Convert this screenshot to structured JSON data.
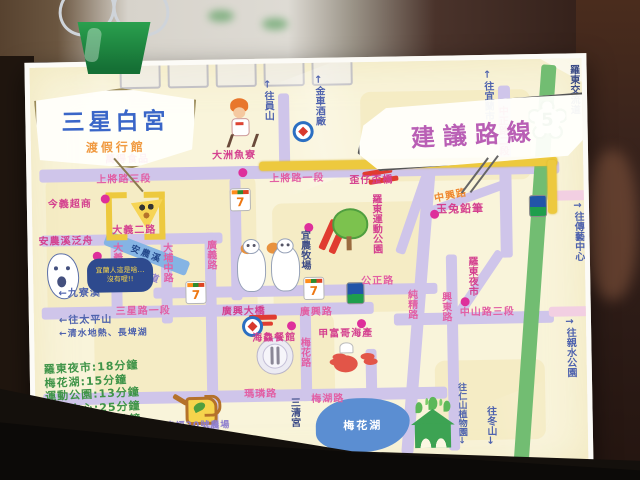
{
  "map": {
    "title_bubble": {
      "name": "三星白宮",
      "subtitle": "渡假行館"
    },
    "route_bubble": {
      "label": "建議路線"
    },
    "highway": {
      "number": "5",
      "interchange_label": "羅東交流道"
    },
    "river": {
      "name": "安農溪"
    },
    "lake": {
      "label": "梅花湖"
    },
    "speech": {
      "lines": [
        "宜蘭人這是啥…",
        "沒有喔!!"
      ]
    },
    "legend": [
      {
        "dest": "羅東夜市",
        "time": "18分鐘"
      },
      {
        "dest": "梅花湖",
        "time": "15分鐘"
      },
      {
        "dest": "運動公園",
        "time": "13分鐘"
      },
      {
        "dest": "傳藝中心",
        "time": "25分鐘"
      },
      {
        "dest": "親水公園",
        "time": "25分鐘"
      }
    ],
    "road_labels": [
      {
        "t": "上將路三段",
        "x": 65,
        "y": 104
      },
      {
        "t": "上將路一段",
        "x": 238,
        "y": 106
      },
      {
        "t": "歪仔歪橋",
        "x": 318,
        "y": 109,
        "c": "pk2"
      },
      {
        "t": "大義二路",
        "x": 80,
        "y": 155,
        "c": "pk2"
      },
      {
        "t": "大義路",
        "x": 76,
        "y": 176,
        "v": 1
      },
      {
        "t": "大埔中路",
        "x": 126,
        "y": 177,
        "v": 1
      },
      {
        "t": "廣義路",
        "x": 170,
        "y": 175,
        "v": 1
      },
      {
        "t": "自行車道",
        "x": 88,
        "y": 200,
        "c": "pur",
        "r": 22,
        "s": 9
      },
      {
        "t": "三星路一段",
        "x": 82,
        "y": 236
      },
      {
        "t": "廣興大橋",
        "x": 188,
        "y": 238,
        "c": "pk2"
      },
      {
        "t": "廣興路",
        "x": 266,
        "y": 240
      },
      {
        "t": "公正路",
        "x": 328,
        "y": 210
      },
      {
        "t": "中興路",
        "x": 402,
        "y": 126,
        "c": "org",
        "r": -10
      },
      {
        "t": "中正路二段",
        "x": 464,
        "y": 46,
        "v": 1,
        "c": "pk2"
      },
      {
        "t": "純精路",
        "x": 370,
        "y": 228,
        "v": 1
      },
      {
        "t": "興東路",
        "x": 404,
        "y": 231,
        "v": 1
      },
      {
        "t": "中山路三段",
        "x": 426,
        "y": 243
      },
      {
        "t": "梅花路",
        "x": 262,
        "y": 274,
        "v": 1
      },
      {
        "t": "瑪璘路",
        "x": 209,
        "y": 321
      },
      {
        "t": "梅湖路",
        "x": 276,
        "y": 327
      }
    ],
    "place_labels": [
      {
        "t": "今義超商",
        "x": 16,
        "y": 128
      },
      {
        "t": "萬得食品",
        "x": 74,
        "y": 84,
        "c": "pink"
      },
      {
        "t": "大洲魚寮",
        "x": 181,
        "y": 82
      },
      {
        "t": "安農溪泛舟",
        "x": 6,
        "y": 165
      },
      {
        "t": "玉兔鉛筆",
        "x": 404,
        "y": 140,
        "s": 11
      },
      {
        "t": "羅東運動公園",
        "x": 336,
        "y": 132,
        "v": 1
      },
      {
        "t": "羅東夜市",
        "x": 431,
        "y": 196,
        "v": 1
      },
      {
        "t": "海鱻餐館",
        "x": 218,
        "y": 265
      },
      {
        "t": "甲富哥海產",
        "x": 284,
        "y": 262
      },
      {
        "t": "宜農牧場",
        "x": 264,
        "y": 167,
        "v": 1,
        "c": "nav"
      },
      {
        "t": "三清宮",
        "x": 251,
        "y": 334,
        "v": 1,
        "c": "nav"
      },
      {
        "t": "幸福20號農場",
        "x": 130,
        "y": 353,
        "c": "pur",
        "s": 9
      }
    ],
    "direction_labels": [
      {
        "t": "↑往員山",
        "x": 230,
        "y": 16,
        "v": 1
      },
      {
        "t": "↑金車酒廠",
        "x": 281,
        "y": 12,
        "v": 1
      },
      {
        "t": "↑往宜蘭市",
        "x": 450,
        "y": 10,
        "v": 1
      },
      {
        "t": "羅東交流道",
        "x": 536,
        "y": 6,
        "v": 1,
        "c": "nav"
      },
      {
        "t": "→往傳藝中心",
        "x": 538,
        "y": 142,
        "v": 1
      },
      {
        "t": "→往親水公園",
        "x": 528,
        "y": 258,
        "v": 1
      },
      {
        "t": "往冬山↓",
        "x": 447,
        "y": 346,
        "v": 1
      },
      {
        "t": "往仁山植物園↓",
        "x": 420,
        "y": 322,
        "v": 1,
        "s": 9
      },
      {
        "t": "←九寮溪",
        "x": 25,
        "y": 217
      },
      {
        "t": "←往太平山",
        "x": 25,
        "y": 244
      },
      {
        "t": "←清水地熱、長埤湖",
        "x": 25,
        "y": 259,
        "s": 9
      }
    ],
    "roads": [
      {
        "x": 8,
        "y": 102,
        "w": 520,
        "h": 13
      },
      {
        "x": 8,
        "y": 168,
        "w": 182,
        "h": 11
      },
      {
        "x": 120,
        "y": 222,
        "w": 284,
        "h": 11
      },
      {
        "x": 8,
        "y": 240,
        "w": 332,
        "h": 12
      },
      {
        "x": 8,
        "y": 326,
        "w": 404,
        "h": 12
      },
      {
        "x": 360,
        "y": 252,
        "w": 160,
        "h": 12
      },
      {
        "x": 515,
        "y": 132,
        "w": 52,
        "h": 10,
        "c": "pinkr"
      },
      {
        "x": 515,
        "y": 248,
        "w": 52,
        "h": 10,
        "c": "pinkr"
      },
      {
        "x": 78,
        "y": 174,
        "w": 11,
        "h": 78
      },
      {
        "x": 128,
        "y": 174,
        "w": 11,
        "h": 84
      },
      {
        "x": 172,
        "y": 168,
        "w": 11,
        "h": 208
      },
      {
        "x": 198,
        "y": 114,
        "w": 11,
        "h": 122
      },
      {
        "x": 248,
        "y": 30,
        "w": 11,
        "h": 80
      },
      {
        "x": 266,
        "y": 240,
        "w": 11,
        "h": 98
      },
      {
        "x": 331,
        "y": 287,
        "w": 11,
        "h": 92
      },
      {
        "x": 413,
        "y": 194,
        "w": 11,
        "h": 196
      },
      {
        "x": 468,
        "y": 26,
        "w": 12,
        "h": 172
      },
      {
        "x": 392,
        "y": 112,
        "w": 12,
        "h": 282,
        "r": 5.5,
        "o": "top center"
      },
      {
        "x": 390,
        "y": 115,
        "w": 10,
        "h": 82,
        "r": 20,
        "o": "top center"
      },
      {
        "x": 463,
        "y": 192,
        "w": 10,
        "h": 76,
        "r": 35,
        "o": "top center"
      },
      {
        "x": 398,
        "y": 146,
        "w": 82,
        "h": 9,
        "r": -19,
        "o": "left center"
      },
      {
        "x": 512,
        "y": 6,
        "w": 15,
        "h": 404,
        "r": 5,
        "o": "top center",
        "c": "grn"
      }
    ],
    "yellow_route": [
      {
        "x": 228,
        "y": 98,
        "w": 298,
        "h": 9
      },
      {
        "x": 516,
        "y": 101,
        "w": 9,
        "h": 54
      },
      {
        "k": "bl",
        "x": 74,
        "y": 126
      },
      {
        "k": "br",
        "x": 112,
        "y": 126
      }
    ],
    "red_dashes": [
      {
        "x": 331,
        "y": 108,
        "w": 30,
        "h": 5,
        "r": -8
      },
      {
        "x": 337,
        "y": 116,
        "w": 30,
        "h": 5,
        "r": -8
      },
      {
        "x": 292,
        "y": 156,
        "w": 7,
        "h": 32,
        "r": 25
      },
      {
        "x": 302,
        "y": 160,
        "w": 7,
        "h": 32,
        "r": 25
      },
      {
        "x": 215,
        "y": 251,
        "w": 28,
        "h": 5,
        "r": 0
      },
      {
        "x": 217,
        "y": 258,
        "w": 22,
        "h": 4,
        "r": 0
      }
    ],
    "dots": [
      [
        69,
        128
      ],
      [
        60,
        185
      ],
      [
        207,
        104
      ],
      [
        272,
        160
      ],
      [
        398,
        149
      ],
      [
        427,
        237
      ],
      [
        253,
        258
      ],
      [
        323,
        257
      ]
    ],
    "icons": [
      {
        "k": "seven",
        "x": 198,
        "y": 124,
        "g": "7"
      },
      {
        "k": "seven",
        "x": 152,
        "y": 216,
        "g": "7"
      },
      {
        "k": "seven",
        "x": 270,
        "y": 214,
        "g": "7"
      },
      {
        "k": "fami",
        "x": 313,
        "y": 220
      },
      {
        "k": "fami",
        "x": 497,
        "y": 136
      },
      {
        "k": "gas",
        "x": 262,
        "y": 58
      },
      {
        "k": "gas",
        "x": 208,
        "y": 252
      },
      {
        "k": "tree",
        "x": 300,
        "y": 146
      },
      {
        "k": "pizza",
        "x": 99,
        "y": 132
      },
      {
        "k": "sheep",
        "x": 202,
        "y": 162
      },
      {
        "k": "plate",
        "x": 222,
        "y": 274
      },
      {
        "k": "crab",
        "x": 293,
        "y": 280
      },
      {
        "k": "can",
        "x": 138,
        "y": 326
      },
      {
        "k": "runner",
        "x": 194,
        "y": 34
      },
      {
        "k": "house",
        "x": 375,
        "y": 336
      },
      {
        "k": "lake",
        "x": 280,
        "y": 336
      },
      {
        "k": "shield",
        "x": 498,
        "y": 42
      }
    ],
    "colors": {
      "road": "#cfc5ea",
      "road_pink": "#f2cfe2",
      "route_yellow": "#edc93e",
      "highway_green": "#72bd72",
      "river_blue": "#85b4e4",
      "lake_blue": "#5b8ed2",
      "label_pink": "#e25fa4",
      "label_blue": "#4f63ae",
      "label_orange": "#ef8830",
      "legend_green": "#3f9448",
      "poi_dot": "#de2f9b",
      "closed_red": "#e03c30"
    }
  }
}
